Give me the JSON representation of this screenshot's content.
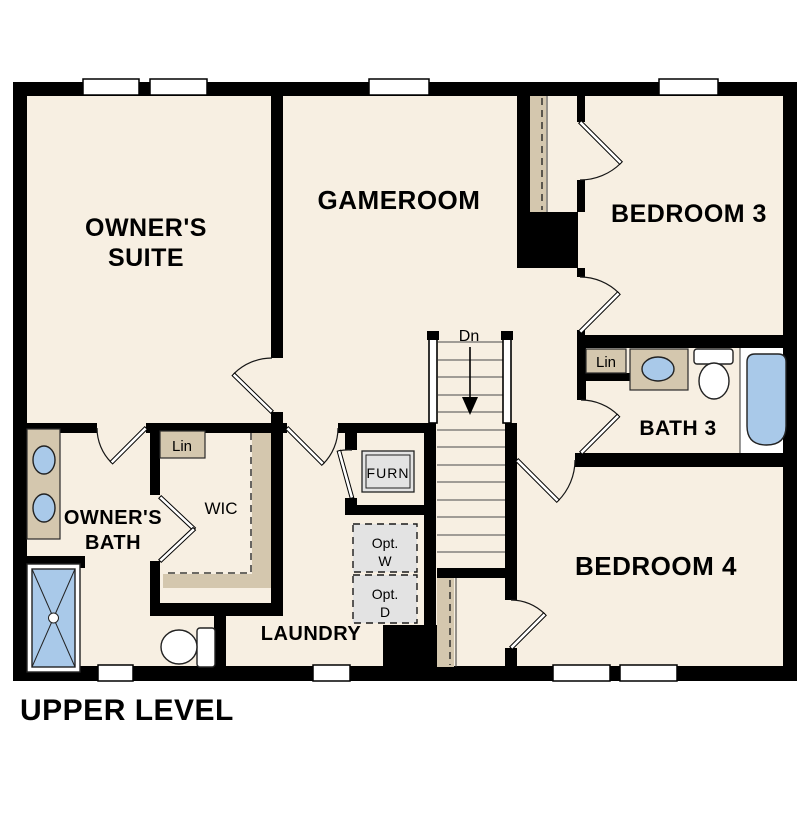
{
  "title": "UPPER LEVEL",
  "colors": {
    "floor": "#f7efe2",
    "wall": "#000000",
    "casework_tan": "#d4c7ae",
    "fixture_blue": "#a9c9e9",
    "equipment_gray": "#e3e3e3",
    "paper": "#ffffff"
  },
  "rooms": {
    "owners_suite": {
      "line1": "OWNER'S",
      "line2": "SUITE"
    },
    "gameroom": {
      "label": "GAMEROOM"
    },
    "bedroom3": {
      "label": "BEDROOM 3"
    },
    "bath3": {
      "label": "BATH 3"
    },
    "bedroom4": {
      "label": "BEDROOM 4"
    },
    "owners_bath": {
      "line1": "OWNER'S",
      "line2": "BATH"
    },
    "wic": {
      "label": "WIC"
    },
    "laundry": {
      "label": "LAUNDRY"
    }
  },
  "annotations": {
    "stairs_down": "Dn",
    "linen_wic": "Lin",
    "linen_bath3": "Lin",
    "furnace": "FURN",
    "opt_washer_line1": "Opt.",
    "opt_washer_line2": "W",
    "opt_dryer_line1": "Opt.",
    "opt_dryer_line2": "D"
  }
}
